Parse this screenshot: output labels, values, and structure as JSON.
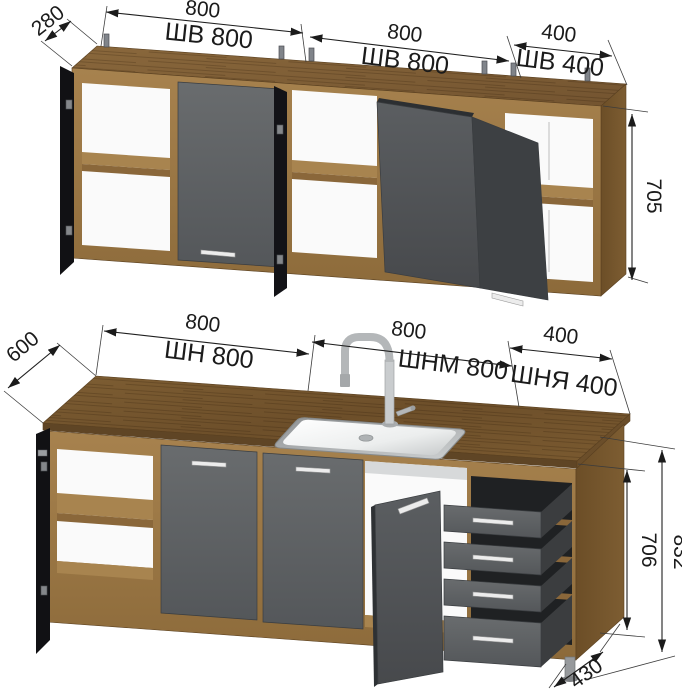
{
  "drawing": {
    "type": "kitchen-set-dimension-drawing",
    "units": "mm",
    "wall_row": {
      "depth": "280",
      "height": "705",
      "cabinets": [
        {
          "label": "ШВ 800",
          "width": "800"
        },
        {
          "label": "ШВ 800",
          "width": "800"
        },
        {
          "label": "ШВ 400",
          "width": "400"
        }
      ]
    },
    "base_row": {
      "depth": "600",
      "body_height": "706",
      "total_height": "832",
      "plinth_depth": "430",
      "cabinets": [
        {
          "label": "ШН 800",
          "width": "800"
        },
        {
          "label": "ШНМ 800",
          "width": "800"
        },
        {
          "label": "ШНЯ 400",
          "width": "400"
        }
      ]
    },
    "colors": {
      "wood_front": "#a07c49",
      "wood_top": "#826038",
      "countertop": "#6f512b",
      "facade_gray": "#5d6062",
      "open_door_dark": "#17171a",
      "dimension_text": "#1b1b1b"
    }
  }
}
